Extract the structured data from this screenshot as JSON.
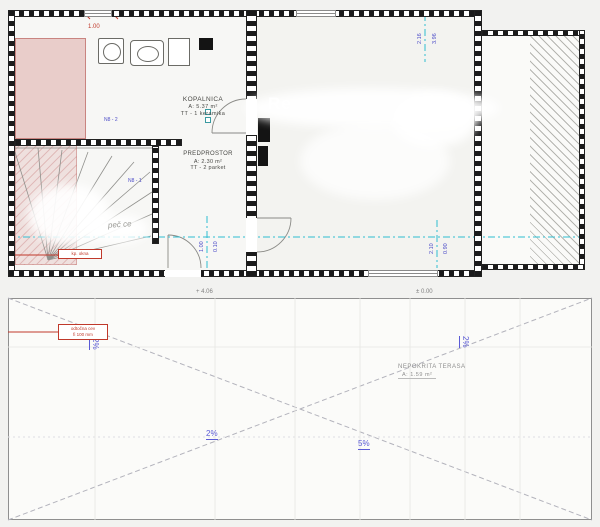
{
  "watermark": {
    "text": "Re"
  },
  "floor_plan": {
    "rooms": {
      "kopalnica": {
        "name": "KOPALNICA",
        "area": "A: 5.37 m²",
        "finish": "TT - 1 keramika"
      },
      "predprostor": {
        "name": "PREDPROSTOR",
        "area": "A: 2.30 m²",
        "finish": "TT - 2 parket"
      }
    },
    "labels": {
      "wall_mark_1": "N8 - 2",
      "wall_mark_2": "N8 - 1",
      "script_note": "peč ce",
      "red_note": "kp. okna"
    },
    "dimensions": {
      "window_width": "1.00",
      "top_pair": [
        "2.16",
        "3.96"
      ],
      "left_pair": [
        "1.00",
        "0.10"
      ],
      "right_pair": [
        "2.10",
        "0.90"
      ],
      "level_left": "+ 4.06",
      "level_right": "± 0.00"
    }
  },
  "roof_plan": {
    "area_label": {
      "name": "NEPOKRITA TERASA",
      "area": "A: 1.59 m²"
    },
    "slopes": {
      "left": "2%",
      "right": "2%",
      "bottom_left": "2%",
      "bottom_right": "5%"
    },
    "note": {
      "line1": "odtočna cev",
      "line2": "fi 100 mm"
    }
  },
  "colors": {
    "cyan": "#2fbdd1",
    "dim_blue": "#4d4dc8",
    "red": "#c0392b",
    "pink": "#e9cdca"
  }
}
